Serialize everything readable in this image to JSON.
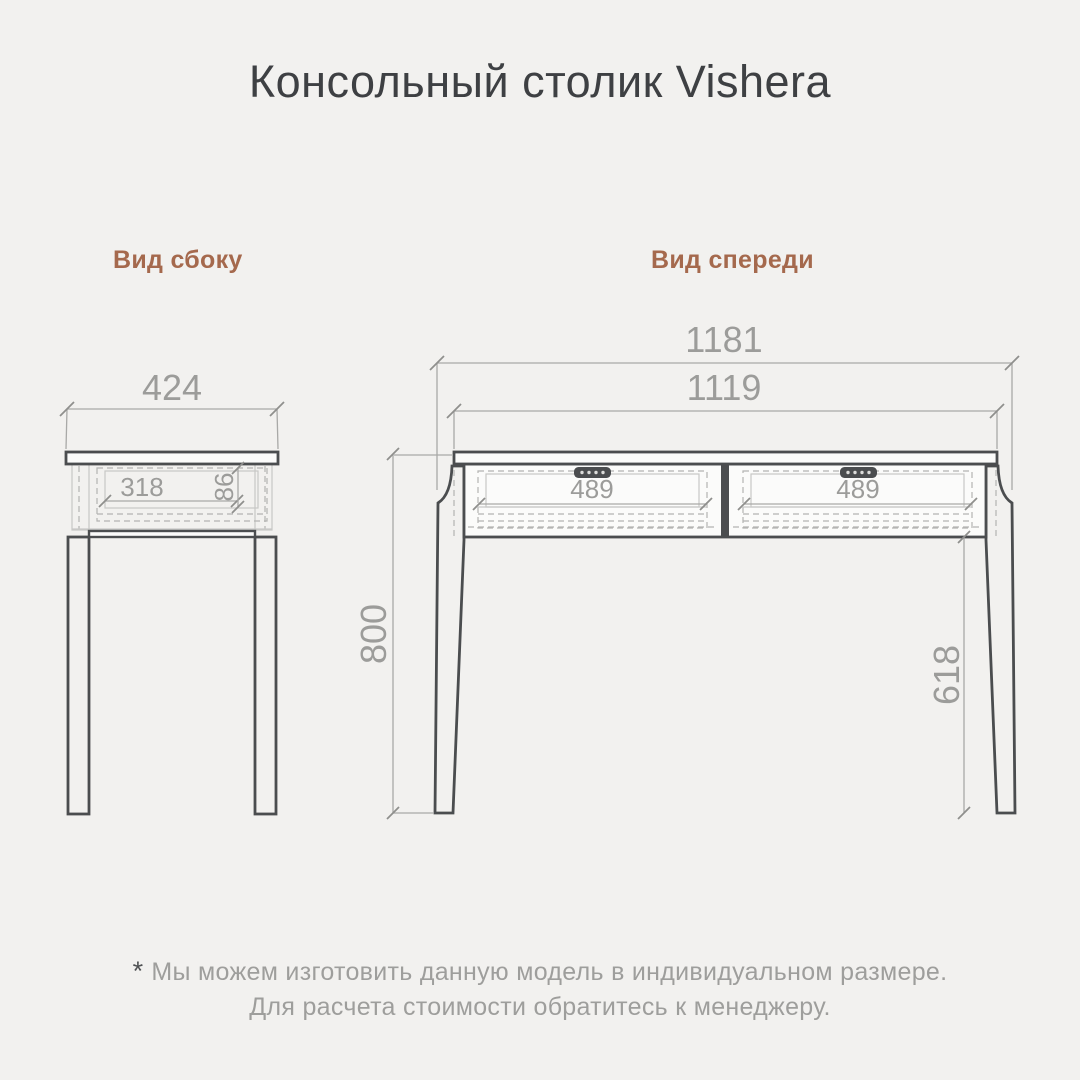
{
  "page": {
    "title": "Консольный столик Vishera",
    "background": "#f2f1ef"
  },
  "colors": {
    "accent_brown": "#a5694d",
    "furniture_line": "#4b4d4f",
    "dimension_gray": "#9c9c9a",
    "title_dark": "#3e4043",
    "footer_gray": "#9e9e9c"
  },
  "views": {
    "side": {
      "label": "Вид сбоку",
      "dimensions": {
        "total_depth": "424",
        "drawer_depth": "318",
        "drawer_height": "86"
      }
    },
    "front": {
      "label": "Вид спереди",
      "dimensions": {
        "total_width": "1181",
        "top_width": "1119",
        "drawer_left_width": "489",
        "drawer_right_width": "489",
        "total_height": "800",
        "leg_clearance_height": "618"
      }
    }
  },
  "footnote": {
    "asterisk": "*",
    "line1": "Мы можем изготовить данную модель в индивидуальном размере.",
    "line2": "Для расчета стоимости обратитесь к менеджеру."
  }
}
